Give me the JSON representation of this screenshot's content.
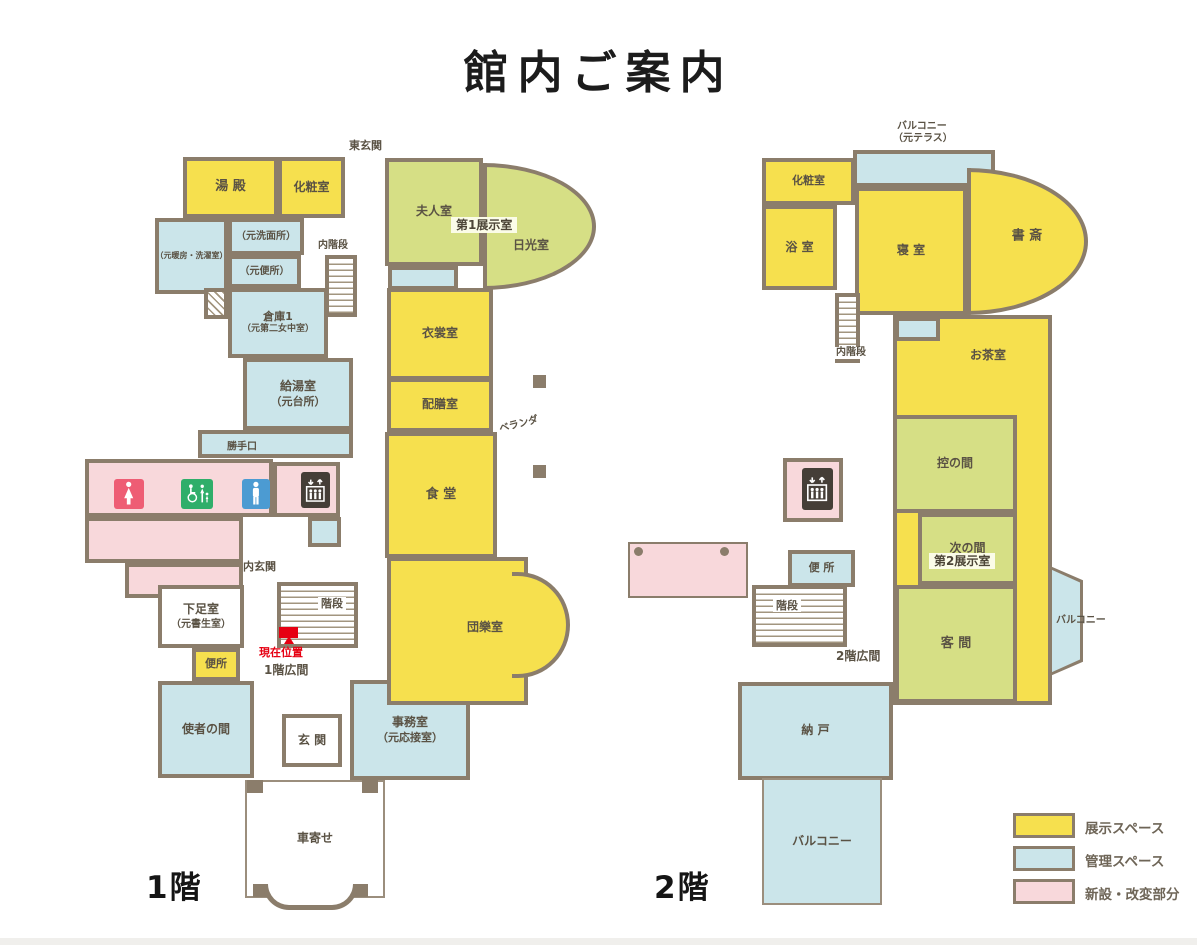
{
  "title": "館内ご案内",
  "colors": {
    "wall": "#8b7d6b",
    "exhibit_yellow": "#f6e04e",
    "exhibit_green": "#d6df85",
    "admin_blue": "#cbe5ea",
    "new_pink": "#f8d8db",
    "women_icon_bg": "#ee5d74",
    "accessible_icon_bg": "#2fae6a",
    "men_icon_bg": "#4c9bd2",
    "elevator_icon_bg": "#453e37",
    "marker_red": "#e60012",
    "label_text": "#5a5244"
  },
  "legend": {
    "x": 1013,
    "y": 813,
    "items": [
      {
        "label": "展示スペース",
        "color": "#f6e04e"
      },
      {
        "label": "管理スペース",
        "color": "#cbe5ea"
      },
      {
        "label": "新設・改変部分",
        "color": "#f8d8db"
      }
    ]
  },
  "floor1": {
    "label": "1階",
    "label_pos": [
      146,
      862
    ],
    "rooms": [
      {
        "id": "yudono",
        "label": "湯 殿",
        "box": [
          183,
          157,
          95,
          61
        ],
        "type": "ex",
        "fs": 13
      },
      {
        "id": "keshoshitsu-1f",
        "label": "化粧室",
        "box": [
          278,
          157,
          67,
          61
        ],
        "type": "ex",
        "fs": 12
      },
      {
        "id": "moto-danbo-sentakushitsu",
        "label": "（元暖房・洗濯室）",
        "box": [
          155,
          218,
          73,
          76
        ],
        "type": "ad",
        "fs": 8
      },
      {
        "id": "moto-senmenjo",
        "label": "（元洗面所）",
        "box": [
          228,
          218,
          76,
          37
        ],
        "type": "ad",
        "fs": 10
      },
      {
        "id": "moto-benjo",
        "label": "（元便所）",
        "box": [
          228,
          255,
          73,
          33
        ],
        "type": "ad",
        "fs": 10
      },
      {
        "id": "souko-1",
        "label": "倉庫1",
        "sub": "（元第二女中室）",
        "box": [
          228,
          288,
          100,
          70
        ],
        "type": "ad",
        "fs": 11,
        "fs2": 9
      },
      {
        "id": "service-winder-stairs",
        "box": [
          204,
          288,
          24,
          31
        ],
        "type": "std"
      },
      {
        "id": "uchikaidan-1f",
        "box": [
          325,
          255,
          32,
          62
        ],
        "type": "st"
      },
      {
        "id": "kyutoshitsu",
        "label": "給湯室",
        "sub": "（元台所）",
        "box": [
          243,
          358,
          110,
          72
        ],
        "type": "ad",
        "fs": 12,
        "fs2": 11
      },
      {
        "id": "katteguchi",
        "label": "勝手口",
        "box": [
          198,
          430,
          155,
          28
        ],
        "type": "ad",
        "fs": 10,
        "labelPos": [
          40,
          13
        ]
      },
      {
        "id": "toilet-block-main",
        "box": [
          85,
          459,
          188,
          58
        ],
        "type": "nw"
      },
      {
        "id": "toilet-block-mid",
        "box": [
          85,
          517,
          158,
          46
        ],
        "type": "nw"
      },
      {
        "id": "toilet-block-low",
        "box": [
          125,
          563,
          118,
          35
        ],
        "type": "nw"
      },
      {
        "id": "elevator-area-1f",
        "box": [
          273,
          462,
          67,
          55
        ],
        "type": "nw"
      },
      {
        "id": "small-admin-1f",
        "box": [
          308,
          517,
          33,
          30
        ],
        "type": "ad"
      },
      {
        "id": "gesokushitsu",
        "label": "下足室",
        "sub": "（元書生室）",
        "box": [
          158,
          585,
          86,
          63
        ],
        "type": "wh",
        "fs": 12,
        "fs2": 10
      },
      {
        "id": "kaidan-1f",
        "box": [
          277,
          582,
          81,
          66
        ],
        "type": "st"
      },
      {
        "id": "benjo-1f",
        "label": "便所",
        "box": [
          192,
          648,
          48,
          33
        ],
        "type": "ex",
        "fs": 11
      },
      {
        "id": "shisha-no-ma",
        "label": "使者の間",
        "box": [
          158,
          681,
          96,
          97
        ],
        "type": "ad",
        "fs": 12
      },
      {
        "id": "genkan",
        "label": "玄 関",
        "box": [
          282,
          714,
          60,
          53
        ],
        "type": "wh",
        "fs": 12
      },
      {
        "id": "jimushitsu",
        "label": "事務室",
        "sub": "（元応接室）",
        "box": [
          350,
          680,
          120,
          100
        ],
        "type": "ad",
        "fs": 12,
        "fs2": 11
      },
      {
        "id": "kurumayose",
        "label": "車寄せ",
        "box": [
          245,
          780,
          140,
          118
        ],
        "type": "out",
        "fs": 12
      },
      {
        "id": "fujinshitsu",
        "label": "夫人室",
        "box": [
          385,
          158,
          98,
          108
        ],
        "type": "g",
        "fs": 12
      },
      {
        "id": "nikkoshitsu",
        "label": "日光室",
        "box": [
          483,
          163,
          113,
          127
        ],
        "type": "g",
        "fs": 12,
        "radius": "0 100% 100% 0 / 0 50% 50% 0",
        "labelPos": [
          44,
          79
        ]
      },
      {
        "id": "admin-strip-1f",
        "box": [
          388,
          266,
          70,
          24
        ],
        "type": "ad"
      },
      {
        "id": "ishoshitsu",
        "label": "衣裳室",
        "box": [
          387,
          288,
          106,
          92
        ],
        "type": "ex",
        "fs": 12
      },
      {
        "id": "haizenshitsu",
        "label": "配膳室",
        "box": [
          387,
          378,
          106,
          54
        ],
        "type": "ex",
        "fs": 12
      },
      {
        "id": "shokudo",
        "label": "食 堂",
        "box": [
          385,
          432,
          112,
          126
        ],
        "type": "ex",
        "fs": 13
      },
      {
        "id": "danranshitsu",
        "label": "団樂室",
        "box": [
          387,
          557,
          141,
          148
        ],
        "type": "ex",
        "fs": 12,
        "labelPos": [
          94,
          67
        ]
      },
      {
        "id": "danran-bay",
        "box": [
          512,
          572,
          58,
          106
        ],
        "type": "ex",
        "radius": "0 90% 90% 0 / 0 50% 50% 0",
        "noLeft": true,
        "z": 2
      },
      {
        "id": "veranda-pillar-1",
        "box": [
          533,
          375,
          13,
          13
        ],
        "type": "pl"
      },
      {
        "id": "veranda-pillar-2",
        "box": [
          533,
          465,
          13,
          13
        ],
        "type": "pl"
      }
    ],
    "texts": [
      {
        "name": "higashi-genkan-label",
        "t": "東玄関",
        "x": 349,
        "y": 139,
        "s": 11
      },
      {
        "name": "uchikaidan-label-1f",
        "t": "内階段",
        "x": 318,
        "y": 240,
        "s": 10
      },
      {
        "name": "veranda-label",
        "t": "ベランダ",
        "x": 499,
        "y": 419,
        "s": 10,
        "rot": -14
      },
      {
        "name": "uchigenkan-label",
        "t": "内玄関",
        "x": 243,
        "y": 560,
        "s": 11
      },
      {
        "name": "kaidan-label-1f",
        "t": "階段",
        "x": 318,
        "y": 597,
        "s": 11,
        "chip": true
      },
      {
        "name": "hall-1f-label",
        "t": "1階広間",
        "x": 264,
        "y": 663,
        "s": 12
      },
      {
        "name": "exhibit1-badge",
        "t": "第1展示室",
        "x": 451,
        "y": 217,
        "s": 12,
        "badge": true
      }
    ],
    "icons": [
      {
        "name": "women-toilet-icon",
        "box": [
          114,
          479,
          30,
          30
        ],
        "bg": "#ee5d74"
      },
      {
        "name": "accessible-toilet-icon",
        "box": [
          181,
          479,
          32,
          30
        ],
        "bg": "#2fae6a"
      },
      {
        "name": "men-toilet-icon",
        "box": [
          242,
          479,
          28,
          30
        ],
        "bg": "#4c9bd2"
      },
      {
        "name": "elevator-icon-1f",
        "glyph": "elevator",
        "box": [
          301,
          472,
          29,
          36
        ],
        "bg": "#453e37"
      }
    ],
    "marker": {
      "rect": [
        279,
        627,
        19,
        11
      ],
      "tri": [
        284,
        636
      ],
      "label": "現在位置",
      "label_pos": [
        259,
        644
      ],
      "s": 11
    },
    "deco": {
      "posts": [
        [
          247,
          780,
          16,
          13
        ],
        [
          362,
          780,
          16,
          13
        ],
        [
          253,
          884,
          21,
          13
        ],
        [
          347,
          884,
          21,
          13
        ]
      ],
      "arch": [
        263,
        884,
        95,
        26
      ]
    }
  },
  "floor2": {
    "label": "2階",
    "label_pos": [
      654,
      862
    ],
    "rooms": [
      {
        "id": "balcony-north-moto-terrace",
        "box": [
          853,
          150,
          142,
          37
        ],
        "type": "ad"
      },
      {
        "id": "keshoshitsu-2f",
        "label": "化粧室",
        "box": [
          762,
          158,
          93,
          47
        ],
        "type": "ex",
        "fs": 11
      },
      {
        "id": "yokushitsu",
        "label": "浴 室",
        "box": [
          762,
          205,
          75,
          85
        ],
        "type": "ex",
        "fs": 12
      },
      {
        "id": "shinshitsu",
        "label": "寝 室",
        "box": [
          855,
          187,
          112,
          128
        ],
        "type": "ex",
        "fs": 12
      },
      {
        "id": "shosai",
        "label": "書 斎",
        "box": [
          967,
          168,
          121,
          147
        ],
        "type": "ex",
        "fs": 13,
        "radius": "0 100% 100% 0 / 0 50% 50% 0",
        "labelPos": [
          56,
          65
        ]
      },
      {
        "id": "uchikaidan-2f",
        "box": [
          835,
          293,
          25,
          70
        ],
        "type": "st"
      },
      {
        "id": "right-wing-2f",
        "box": [
          893,
          315,
          159,
          390
        ],
        "type": "ex"
      },
      {
        "id": "admin-small-2f",
        "box": [
          895,
          317,
          45,
          24
        ],
        "type": "ad"
      },
      {
        "id": "hikae-no-ma",
        "label": "控の間",
        "box": [
          893,
          415,
          124,
          98
        ],
        "type": "g",
        "fs": 12
      },
      {
        "id": "tsugi-no-ma",
        "label": "次の間",
        "box": [
          918,
          513,
          99,
          72
        ],
        "type": "g",
        "fs": 12
      },
      {
        "id": "kyakuma",
        "label": "客 間",
        "box": [
          895,
          585,
          122,
          118
        ],
        "type": "g",
        "fs": 13
      },
      {
        "id": "balcony-east",
        "box": [
          1050,
          566,
          33,
          110
        ],
        "type": "ad",
        "clip": "polygon(0 0, 100% 13%, 100% 87%, 0 100%)"
      },
      {
        "id": "elevator-area-2f",
        "box": [
          783,
          458,
          60,
          64
        ],
        "type": "nw"
      },
      {
        "id": "renovated-deck",
        "box": [
          628,
          542,
          120,
          56
        ],
        "type": "nw",
        "bw": 2
      },
      {
        "id": "deck-dot-1",
        "box": [
          634,
          547,
          9,
          9
        ],
        "type": "dot"
      },
      {
        "id": "deck-dot-2",
        "box": [
          720,
          547,
          9,
          9
        ],
        "type": "dot"
      },
      {
        "id": "benjo-2f",
        "label": "便 所",
        "box": [
          788,
          550,
          67,
          37
        ],
        "type": "ad",
        "fs": 11
      },
      {
        "id": "kaidan-2f",
        "box": [
          752,
          585,
          95,
          62
        ],
        "type": "st"
      },
      {
        "id": "nando",
        "label": "納 戸",
        "box": [
          738,
          682,
          155,
          98
        ],
        "type": "ad",
        "fs": 12
      },
      {
        "id": "balcony-south",
        "label": "バルコニー",
        "box": [
          762,
          778,
          120,
          127
        ],
        "type": "outb",
        "fs": 12
      }
    ],
    "texts": [
      {
        "name": "balcony-north-label-line1",
        "t": "バルコニー",
        "x": 897,
        "y": 121,
        "s": 10
      },
      {
        "name": "balcony-north-label-line2",
        "t": "（元テラス）",
        "x": 893,
        "y": 133,
        "s": 10
      },
      {
        "name": "ochashitsu-label",
        "t": "お茶室",
        "x": 970,
        "y": 348,
        "s": 12
      },
      {
        "name": "uchikaidan-label-2f",
        "t": "内階段",
        "x": 833,
        "y": 347,
        "s": 10,
        "chip": true
      },
      {
        "name": "kaidan-label-2f",
        "t": "階段",
        "x": 773,
        "y": 599,
        "s": 11,
        "chip": true
      },
      {
        "name": "hall-2f-label",
        "t": "2階広間",
        "x": 836,
        "y": 649,
        "s": 12
      },
      {
        "name": "exhibit2-badge",
        "t": "第2展示室",
        "x": 929,
        "y": 553,
        "s": 12,
        "badge": true
      },
      {
        "name": "balcony-east-label",
        "t": "バルコニー",
        "x": 1056,
        "y": 615,
        "s": 10
      }
    ],
    "icons": [
      {
        "name": "elevator-icon-2f",
        "glyph": "elevator",
        "box": [
          802,
          468,
          31,
          42
        ],
        "bg": "#453e37"
      }
    ]
  }
}
